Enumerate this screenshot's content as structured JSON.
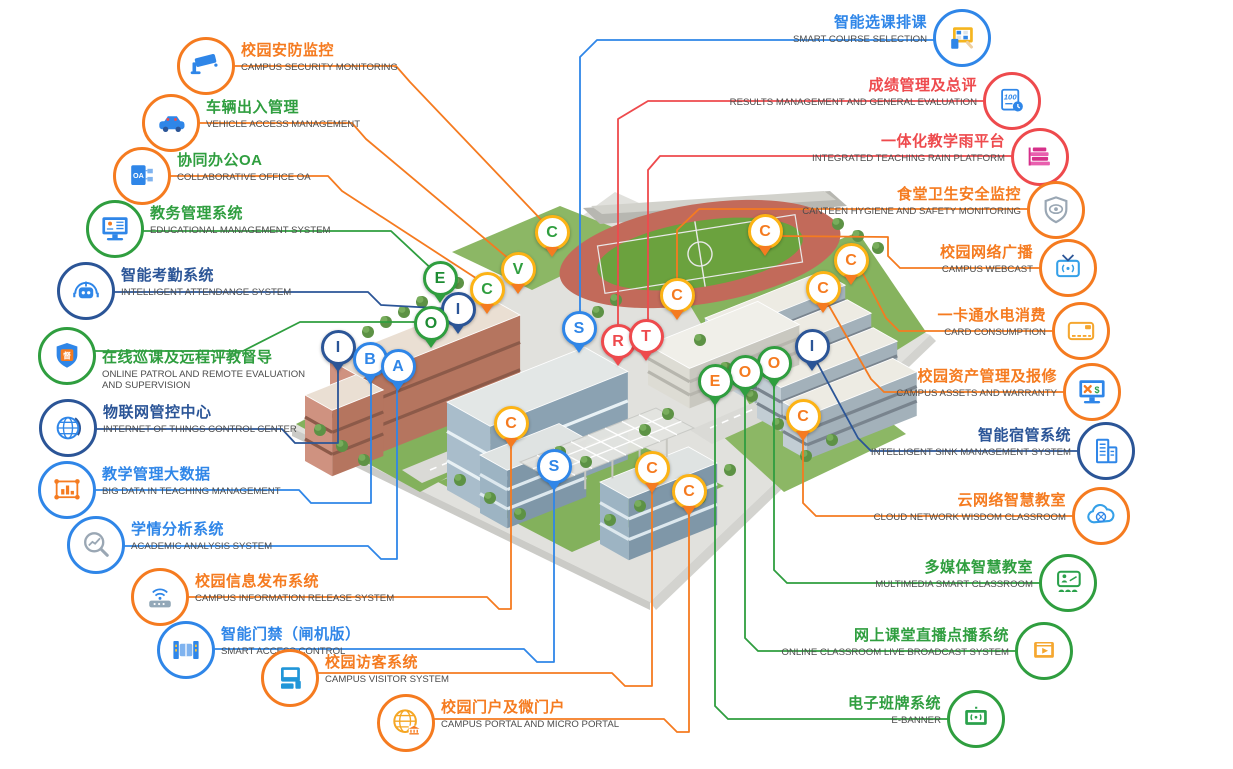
{
  "diagram_title": "Smart Campus Systems Map",
  "palette": {
    "orange": "#f57b20",
    "gold": "#fcb315",
    "green": "#2f9e3f",
    "dgreen": "#1d8c33",
    "navy": "#2b5597",
    "blue": "#2f86e8",
    "red": "#ee4a4d",
    "gray_text": "#4c4c4c"
  },
  "labels": {
    "left": [
      {
        "id": "campus-security-monitoring",
        "zh": "校园安防监控",
        "en": "CAMPUS SECURITY MONITORING",
        "color": "orange",
        "ring": "orange",
        "icon": "security-camera-icon",
        "cx": 206,
        "cy": 66
      },
      {
        "id": "vehicle-access-management",
        "zh": "车辆出入管理",
        "en": "VEHICLE ACCESS MANAGEMENT",
        "color": "green",
        "ring": "orange",
        "icon": "vehicle-car-icon",
        "cx": 171,
        "cy": 123
      },
      {
        "id": "collaborative-office-oa",
        "zh": "协同办公OA",
        "en": "COLLABORATIVE OFFICE OA",
        "color": "green",
        "ring": "orange",
        "icon": "oa-document-icon",
        "cx": 142,
        "cy": 176
      },
      {
        "id": "educational-management-system",
        "zh": "教务管理系统",
        "en": "EDUCATIONAL MANAGEMENT SYSTEM",
        "color": "green",
        "ring": "green",
        "icon": "edu-monitor-icon",
        "cx": 115,
        "cy": 229
      },
      {
        "id": "intelligent-attendance-system",
        "zh": "智能考勤系统",
        "en": "INTELLIGENT ATTENDANCE SYSTEM",
        "color": "navy",
        "ring": "navy",
        "icon": "attendance-robot-icon",
        "cx": 86,
        "cy": 291
      },
      {
        "id": "online-patrol-supervision",
        "zh": "在线巡课及远程评教督导",
        "en": "ONLINE PATROL AND REMOTE EVALUATION AND SUPERVISION",
        "color": "green",
        "ring": "green",
        "icon": "patrol-shield-icon",
        "cx": 67,
        "cy": 356,
        "dy": 17,
        "wrap": true
      },
      {
        "id": "iot-control-center",
        "zh": "物联网管控中心",
        "en": "INTERNET OF THINGS CONTROL CENTER",
        "color": "navy",
        "ring": "navy",
        "icon": "iot-globe-icon",
        "cx": 68,
        "cy": 428
      },
      {
        "id": "big-data-teaching",
        "zh": "教学管理大数据",
        "en": "BIG DATA IN TEACHING MANAGEMENT",
        "color": "blue",
        "ring": "blue",
        "icon": "bigdata-chart-icon",
        "cx": 67,
        "cy": 490
      },
      {
        "id": "academic-analysis-system",
        "zh": "学情分析系统",
        "en": "ACADEMIC ANALYSIS SYSTEM",
        "color": "blue",
        "ring": "blue",
        "icon": "academic-magnifier-icon",
        "cx": 96,
        "cy": 545
      },
      {
        "id": "campus-information-release",
        "zh": "校园信息发布系统",
        "en": "CAMPUS INFORMATION RELEASE SYSTEM",
        "color": "orange",
        "ring": "orange",
        "icon": "info-router-icon",
        "cx": 160,
        "cy": 597
      },
      {
        "id": "smart-access-control",
        "zh": "智能门禁（闸机版）",
        "en": "SMART ACCESS CONTROL",
        "color": "blue",
        "ring": "blue",
        "icon": "access-gate-icon",
        "cx": 186,
        "cy": 650
      },
      {
        "id": "campus-visitor-system",
        "zh": "校园访客系统",
        "en": "CAMPUS VISITOR SYSTEM",
        "color": "orange",
        "ring": "orange",
        "icon": "visitor-monitor-icon",
        "cx": 290,
        "cy": 678
      },
      {
        "id": "campus-portal",
        "zh": "校园门户及微门户",
        "en": "CAMPUS PORTAL AND MICRO PORTAL",
        "color": "orange",
        "ring": "orange",
        "icon": "portal-globe-icon",
        "cx": 406,
        "cy": 723
      }
    ],
    "right": [
      {
        "id": "smart-course-selection",
        "zh": "智能选课排课",
        "en": "SMART COURSE SELECTION",
        "color": "blue",
        "ring": "blue",
        "icon": "course-tablet-icon",
        "cx": 962,
        "cy": 38
      },
      {
        "id": "results-management",
        "zh": "成绩管理及总评",
        "en": "RESULTS MANAGEMENT AND GENERAL EVALUATION",
        "color": "red",
        "ring": "red",
        "icon": "score-100-icon",
        "cx": 1012,
        "cy": 101
      },
      {
        "id": "integrated-teaching-rain-platform",
        "zh": "一体化教学雨平台",
        "en": "INTEGRATED TEACHING RAIN PLATFORM",
        "color": "red",
        "ring": "red",
        "icon": "rain-books-icon",
        "cx": 1040,
        "cy": 157
      },
      {
        "id": "canteen-hygiene-monitoring",
        "zh": "食堂卫生安全监控",
        "en": "CANTEEN HYGIENE AND SAFETY MONITORING",
        "color": "orange",
        "ring": "orange",
        "icon": "canteen-shield-icon",
        "cx": 1056,
        "cy": 210
      },
      {
        "id": "campus-webcast",
        "zh": "校园网络广播",
        "en": "CAMPUS WEBCAST",
        "color": "orange",
        "ring": "orange",
        "icon": "webcast-tv-icon",
        "cx": 1068,
        "cy": 268
      },
      {
        "id": "card-consumption",
        "zh": "一卡通水电消费",
        "en": "CARD CONSUMPTION",
        "color": "orange",
        "ring": "orange",
        "icon": "card-icon",
        "cx": 1081,
        "cy": 331
      },
      {
        "id": "campus-assets-warranty",
        "zh": "校园资产管理及报修",
        "en": "CAMPUS ASSETS AND WARRANTY",
        "color": "orange",
        "ring": "orange",
        "icon": "assets-monitor-icon",
        "cx": 1092,
        "cy": 392
      },
      {
        "id": "intelligent-sink-management",
        "zh": "智能宿管系统",
        "en": "INTELLIGENT SINK MANAGEMENT SYSTEM",
        "color": "navy",
        "ring": "navy",
        "icon": "sink-building-icon",
        "cx": 1106,
        "cy": 451
      },
      {
        "id": "cloud-network-wisdom-classroom",
        "zh": "云网络智慧教室",
        "en": "CLOUD NETWORK WISDOM CLASSROOM",
        "color": "orange",
        "ring": "orange",
        "icon": "cloud-icon",
        "cx": 1101,
        "cy": 516
      },
      {
        "id": "multimedia-smart-classroom",
        "zh": "多媒体智慧教室",
        "en": "MULTIMEDIA SMART CLASSROOM",
        "color": "green",
        "ring": "green",
        "icon": "multimedia-screen-icon",
        "cx": 1068,
        "cy": 583
      },
      {
        "id": "online-classroom-broadcast",
        "zh": "网上课堂直播点播系统",
        "en": "ONLINE CLASSROOM LIVE BROADCAST SYSTEM",
        "color": "green",
        "ring": "green",
        "icon": "broadcast-play-icon",
        "cx": 1044,
        "cy": 651
      },
      {
        "id": "e-banner-system",
        "zh": "电子班牌系统",
        "en": "E-BANNER",
        "color": "green",
        "ring": "green",
        "icon": "ebanner-screen-icon",
        "cx": 976,
        "cy": 719
      }
    ]
  },
  "pins": [
    {
      "letter": "C",
      "x": 552,
      "y": 235,
      "ring": "gold",
      "fill": "green",
      "tail": "orange"
    },
    {
      "letter": "V",
      "x": 518,
      "y": 272,
      "ring": "gold",
      "fill": "green",
      "tail": "orange"
    },
    {
      "letter": "C",
      "x": 487,
      "y": 292,
      "ring": "gold",
      "fill": "green",
      "tail": "orange"
    },
    {
      "letter": "E",
      "x": 440,
      "y": 281,
      "ring": "green",
      "fill": "dgreen",
      "tail": "green"
    },
    {
      "letter": "I",
      "x": 458,
      "y": 312,
      "ring": "navy",
      "fill": "navy",
      "tail": "navy"
    },
    {
      "letter": "O",
      "x": 431,
      "y": 326,
      "ring": "green",
      "fill": "dgreen",
      "tail": "green"
    },
    {
      "letter": "I",
      "x": 338,
      "y": 350,
      "ring": "navy",
      "fill": "navy",
      "tail": "navy"
    },
    {
      "letter": "B",
      "x": 370,
      "y": 362,
      "ring": "blue",
      "fill": "blue",
      "tail": "blue"
    },
    {
      "letter": "A",
      "x": 398,
      "y": 369,
      "ring": "blue",
      "fill": "blue",
      "tail": "blue"
    },
    {
      "letter": "S",
      "x": 579,
      "y": 331,
      "ring": "blue",
      "fill": "blue",
      "tail": "blue"
    },
    {
      "letter": "R",
      "x": 618,
      "y": 344,
      "ring": "red",
      "fill": "red",
      "tail": "red"
    },
    {
      "letter": "T",
      "x": 646,
      "y": 339,
      "ring": "red",
      "fill": "red",
      "tail": "red"
    },
    {
      "letter": "C",
      "x": 677,
      "y": 298,
      "ring": "gold",
      "fill": "orange",
      "tail": "orange"
    },
    {
      "letter": "C",
      "x": 765,
      "y": 234,
      "ring": "gold",
      "fill": "orange",
      "tail": "orange"
    },
    {
      "letter": "C",
      "x": 851,
      "y": 263,
      "ring": "gold",
      "fill": "orange",
      "tail": "orange"
    },
    {
      "letter": "C",
      "x": 823,
      "y": 291,
      "ring": "gold",
      "fill": "orange",
      "tail": "orange"
    },
    {
      "letter": "I",
      "x": 812,
      "y": 349,
      "ring": "navy",
      "fill": "navy",
      "tail": "navy"
    },
    {
      "letter": "O",
      "x": 774,
      "y": 366,
      "ring": "green",
      "fill": "orange",
      "tail": "green"
    },
    {
      "letter": "O",
      "x": 745,
      "y": 375,
      "ring": "green",
      "fill": "orange",
      "tail": "green"
    },
    {
      "letter": "E",
      "x": 715,
      "y": 384,
      "ring": "green",
      "fill": "orange",
      "tail": "green"
    },
    {
      "letter": "C",
      "x": 803,
      "y": 419,
      "ring": "gold",
      "fill": "orange",
      "tail": "orange"
    },
    {
      "letter": "C",
      "x": 511,
      "y": 426,
      "ring": "gold",
      "fill": "orange",
      "tail": "orange"
    },
    {
      "letter": "S",
      "x": 554,
      "y": 469,
      "ring": "blue",
      "fill": "blue",
      "tail": "blue"
    },
    {
      "letter": "C",
      "x": 652,
      "y": 471,
      "ring": "gold",
      "fill": "orange",
      "tail": "orange"
    },
    {
      "letter": "C",
      "x": 689,
      "y": 494,
      "ring": "gold",
      "fill": "orange",
      "tail": "orange"
    }
  ],
  "connectors": [
    {
      "c": "orange",
      "p": "234,66 396,66 410,82 549,228"
    },
    {
      "c": "orange",
      "p": "199,123 352,123 366,139 515,264"
    },
    {
      "c": "orange",
      "p": "170,176 328,176 342,191 485,284"
    },
    {
      "c": "green",
      "p": "143,231 391,231 437,274"
    },
    {
      "c": "navy",
      "p": "114,292 368,292 381,305 453,309"
    },
    {
      "c": "green",
      "p": "95,351 243,351 300,322 428,322"
    },
    {
      "c": "navy",
      "p": "96,429 282,429 295,443 338,443 338,352"
    },
    {
      "c": "blue",
      "p": "95,490 299,490 311,503 371,503 371,364"
    },
    {
      "c": "blue",
      "p": "124,546 368,546 381,559 397,559 397,371"
    },
    {
      "c": "orange",
      "p": "188,597 487,597 499,609 511,609 511,428"
    },
    {
      "c": "blue",
      "p": "214,649 524,649 537,662 554,662 554,471"
    },
    {
      "c": "orange",
      "p": "318,673 612,673 625,686 652,686 652,473"
    },
    {
      "c": "orange",
      "p": "434,719 664,719 677,732 689,732 689,496"
    },
    {
      "c": "blue",
      "p": "934,40 597,40 580,57 580,333"
    },
    {
      "c": "red",
      "p": "985,101 648,101 618,119 618,346"
    },
    {
      "c": "red",
      "p": "1013,156 660,156 648,170 648,341"
    },
    {
      "c": "orange",
      "p": "1028,209 699,209 677,230 677,294"
    },
    {
      "c": "orange",
      "p": "1040,268 900,268 888,256 888,237 778,236"
    },
    {
      "c": "orange",
      "p": "1053,331 899,331 886,318 861,270"
    },
    {
      "c": "orange",
      "p": "1064,392 884,392 871,379 824,297"
    },
    {
      "c": "navy",
      "p": "1078,451 871,451 858,438 813,355"
    },
    {
      "c": "orange",
      "p": "1073,516 816,516 803,503 803,422"
    },
    {
      "c": "green",
      "p": "1040,583 787,583 774,570 774,370"
    },
    {
      "c": "green",
      "p": "1016,651 758,651 745,638 745,379"
    },
    {
      "c": "green",
      "p": "948,719 728,719 715,706 715,388"
    }
  ]
}
